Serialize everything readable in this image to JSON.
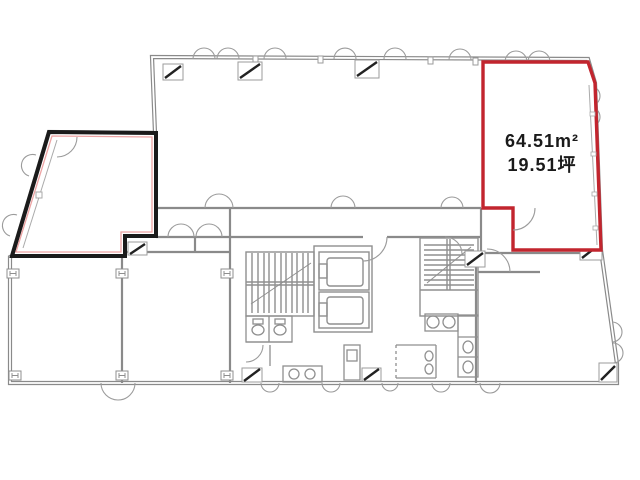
{
  "document": {
    "kind": "building-floor-plan"
  },
  "units": {
    "highlighted": {
      "area_sqm": "64.51m²",
      "area_tsubo": "19.51坪",
      "outline_color": "#c2252e"
    },
    "secondary": {
      "outline_color": "#1b1b1b",
      "inner_line_color": "#eda4a4"
    }
  },
  "plan": {
    "background": "#ffffff",
    "wall_color": "#8a8a8a",
    "line_color": "#9b9b9b",
    "fixture_color": "#8f8f8f",
    "column_hatch_color": "#222222",
    "text_color": "#1a1a1a"
  }
}
